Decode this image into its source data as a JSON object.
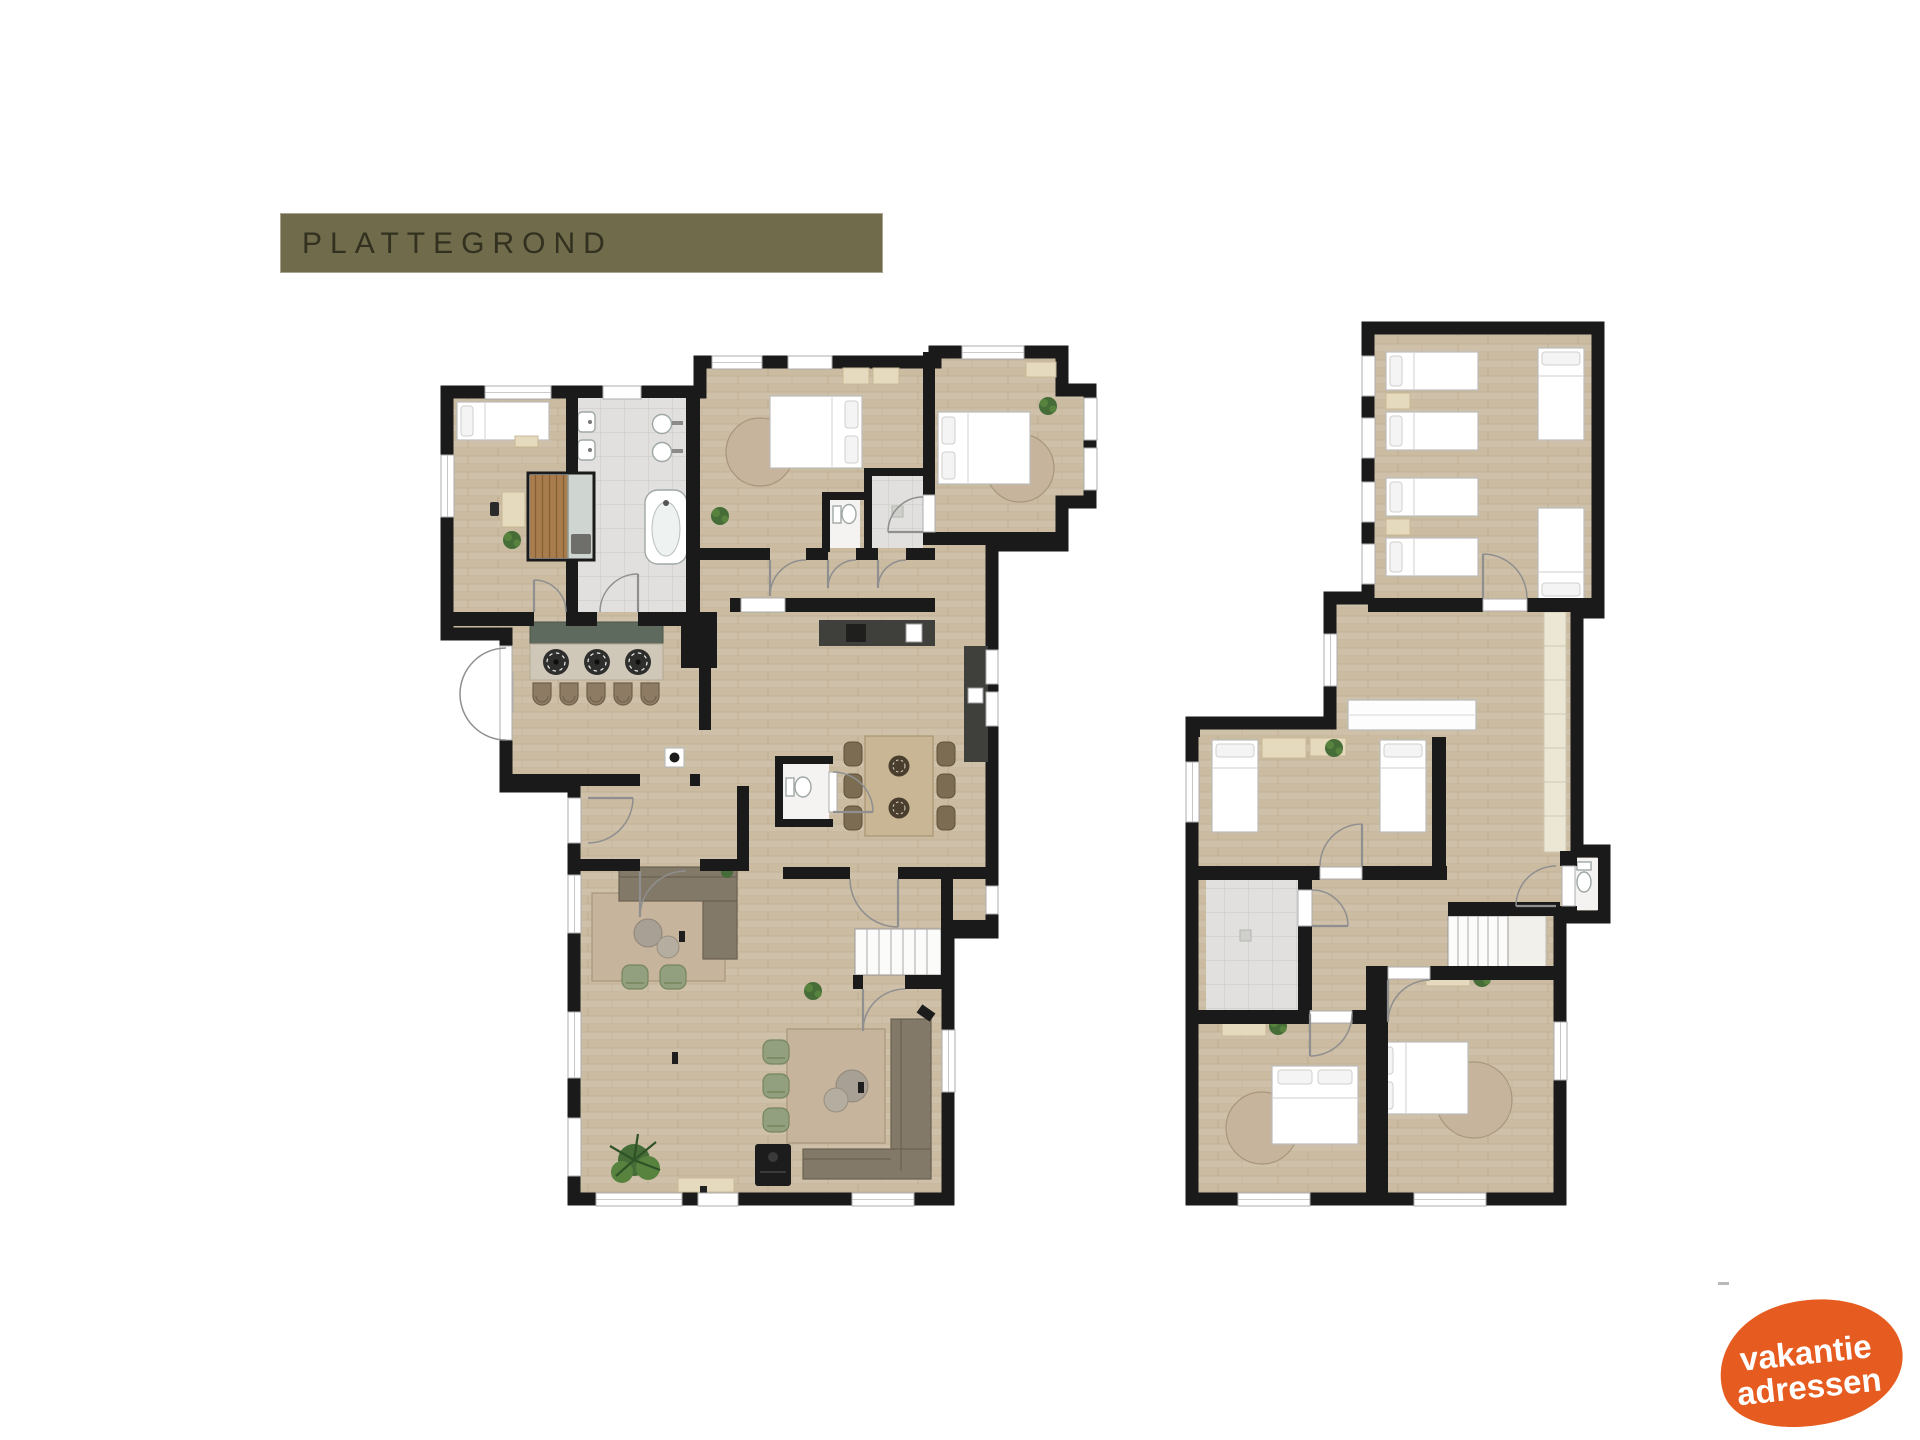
{
  "title_bar": {
    "label": "PLATTEGROND"
  },
  "logo": {
    "line1": "vakantie",
    "line2": "adressen"
  },
  "colors": {
    "background": "#ffffff",
    "title_bg": "#6f6b4b",
    "title_text": "#32301f",
    "wall": "#1a1a1a",
    "floor_wood": "#cdbea6",
    "floor_tile": "#e1e0de",
    "island_top": "#5d6a5d",
    "chair_green": "#93a07f",
    "sofa": "#837968",
    "rug": "#c7b49c",
    "sauna_wood": "#a87c4c",
    "logo_bg": "#e65b1f",
    "logo_text": "#ffffff"
  },
  "plans": [
    {
      "id": "ground-floor",
      "position": "left",
      "features": [
        "bedroom-with-single-bed",
        "sauna-cabin",
        "tiled-bathroom-with-bathtub",
        "double-sinks",
        "two-double-bedrooms",
        "ensuite-toilet",
        "ensuite-shower",
        "kitchen-island-with-hob-and-stools",
        "l-shaped-kitchen-counter",
        "dining-table-six-chairs",
        "guest-toilet",
        "hall",
        "lounge-corner-sofa",
        "living-room",
        "wood-stove",
        "indoor-plant",
        "staircase"
      ]
    },
    {
      "id": "first-floor",
      "position": "right",
      "features": [
        "dormitory-four-single-beds",
        "dormitory-two-single-beds",
        "landing",
        "built-in-wardrobe",
        "twin-bedroom",
        "tiled-shower-room",
        "separate-toilet",
        "staircase",
        "double-bedroom-left",
        "double-bedroom-right",
        "round-rugs",
        "plants"
      ]
    }
  ]
}
